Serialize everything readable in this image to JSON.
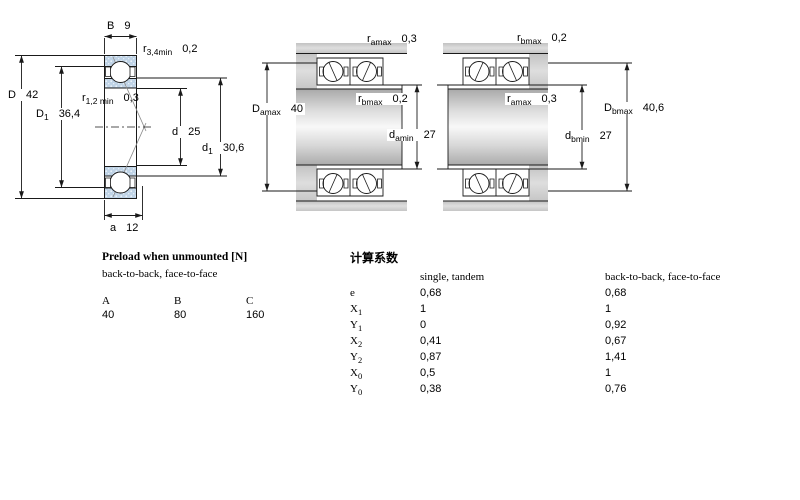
{
  "dims": {
    "B": {
      "sym": "B",
      "sub": "",
      "val": "9"
    },
    "r34": {
      "sym": "r",
      "sub": "3,4min",
      "val": "0,2"
    },
    "D": {
      "sym": "D",
      "sub": "",
      "val": "42"
    },
    "D1": {
      "sym": "D",
      "sub": "1",
      "val": "36,4"
    },
    "r12": {
      "sym": "r",
      "sub": "1,2 min",
      "val": "0,3"
    },
    "d": {
      "sym": "d",
      "sub": "",
      "val": "25"
    },
    "d1": {
      "sym": "d",
      "sub": "1",
      "val": "30,6"
    },
    "a": {
      "sym": "a",
      "sub": "",
      "val": "12"
    },
    "ramax_a": {
      "sym": "r",
      "sub": "amax",
      "val": "0,3"
    },
    "rbmax_a": {
      "sym": "r",
      "sub": "bmax",
      "val": "0,2"
    },
    "Damax": {
      "sym": "D",
      "sub": "amax",
      "val": "40"
    },
    "damin": {
      "sym": "d",
      "sub": "amin",
      "val": "27"
    },
    "rbmax_b": {
      "sym": "r",
      "sub": "bmax",
      "val": "0,2"
    },
    "ramax_b": {
      "sym": "r",
      "sub": "amax",
      "val": "0,3"
    },
    "Dbmax": {
      "sym": "D",
      "sub": "bmax",
      "val": "40,6"
    },
    "dbmin": {
      "sym": "d",
      "sub": "bmin",
      "val": "27"
    }
  },
  "preload": {
    "title": "Preload when unmounted [N]",
    "subtitle": "back-to-back, face-to-face",
    "cols": [
      "A",
      "B",
      "C"
    ],
    "vals": [
      "40",
      "80",
      "160"
    ]
  },
  "factors": {
    "title": "计算系数",
    "h1": "single, tandem",
    "h2": "back-to-back, face-to-face",
    "rows": [
      {
        "sym": "e",
        "sub": "",
        "v1": "0,68",
        "v2": "0,68"
      },
      {
        "sym": "X",
        "sub": "1",
        "v1": "1",
        "v2": "1"
      },
      {
        "sym": "Y",
        "sub": "1",
        "v1": "0",
        "v2": "0,92"
      },
      {
        "sym": "X",
        "sub": "2",
        "v1": "0,41",
        "v2": "0,67"
      },
      {
        "sym": "Y",
        "sub": "2",
        "v1": "0,87",
        "v2": "1,41"
      },
      {
        "sym": "X",
        "sub": "0",
        "v1": "0,5",
        "v2": "1"
      },
      {
        "sym": "Y",
        "sub": "0",
        "v1": "0,38",
        "v2": "0,76"
      }
    ]
  },
  "colors": {
    "ring_blue": "#bfd3e6",
    "line_black": "#1a1a1a",
    "metal_gray": "#bdbdbd"
  }
}
